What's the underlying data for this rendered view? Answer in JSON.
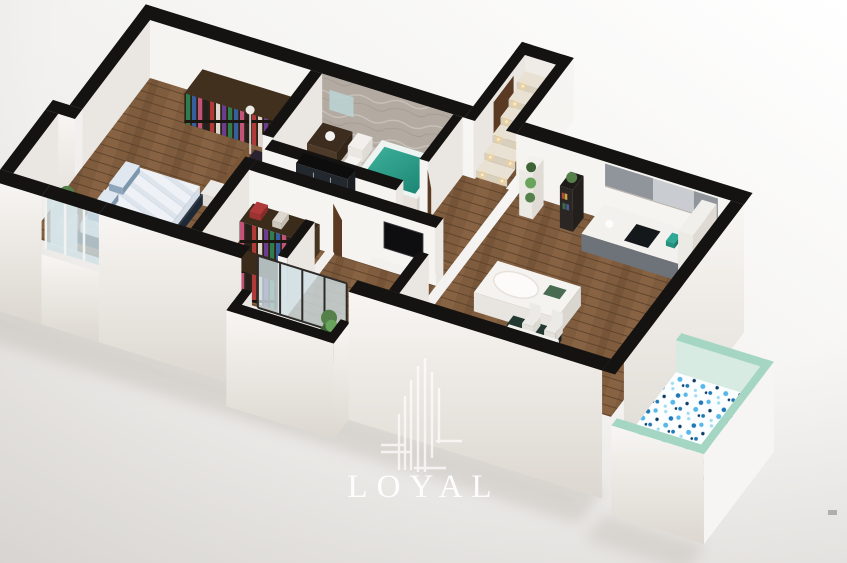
{
  "logo": {
    "brand": "LOYAL"
  },
  "palette": {
    "bg_top": "#ffffff",
    "bg_bottom": "#e7e5e2",
    "vignette": "#bbb7b2",
    "wall_top": "#151312",
    "wall_face": "#f6f4f1",
    "wall_face_shade": "#eae6e1",
    "wall_inner": "#efece7",
    "facade_hi": "#f8f6f3",
    "facade_lo": "#dcd7d0",
    "wood": "#7e5c3d",
    "wood_light": "#8d6a47",
    "wood_dark": "#6b4c33",
    "plank": "#5a3f29",
    "tile": "#cdc6be",
    "tile_line": "#bbb3aa",
    "marble": "#b3aba2",
    "marble_vein": "#d0c9c1",
    "marble_dark": "#978e84",
    "tub_teal": "#3fb39e",
    "tub_teal_deep": "#17806e",
    "tub_rim": "#eef4f1",
    "glass": "#cfe0e5",
    "frame_dark": "#2e2b28",
    "frame_white": "#f2f2f0",
    "bed_base": "#2e3b49",
    "bed_base_dark": "#232f3b",
    "duvet": "#eef1f5",
    "duvet_shade": "#dde4ec",
    "pillow": "#8ea6bc",
    "pillow_top": "#dfe7f0",
    "wardrobe": "#41301d",
    "wardrobe_side": "#4e3a24",
    "wardrobe_dark": "#2e2214",
    "desk": "#7a5536",
    "desk_face": "#6e4c30",
    "desk_side": "#5a3c25",
    "monitor": "#8046a8",
    "chair_white": "#eceae6",
    "chair_shade": "#dcd8d2",
    "tv": "#0e0e10",
    "console": "#f3f1ed",
    "console_face": "#e9e6e1",
    "console_side": "#ddd9d3",
    "cab_face": "#6e737a",
    "cab_side": "#585d63",
    "cab_upper": "#8f959b",
    "cab_upper_light": "#c9ccd0",
    "counter": "#f2f1ee",
    "cooktop": "#15181b",
    "kettle_teal": "#2fa896",
    "island_top": "#f5f3f0",
    "island_face": "#e8e5e0",
    "island_side": "#d9d5cf",
    "bench_dark": "#233831",
    "table_top": "#f4f2ee",
    "table_face": "#e3e0da",
    "shelf_dark": "#2b2623",
    "shelf_white": "#f3f1ed",
    "plant": "#55804a",
    "plant_dark": "#3e6336",
    "plant_light": "#6aa45c",
    "pot": "#a8a49c",
    "mint": "#a5d6c4",
    "mint_light": "#d7ebe2",
    "terrace_white": "#f6f5f3",
    "mosaic_bg": "#fbfdfe",
    "mosaic_blue": "#57b8e8",
    "mosaic_deep": "#1f77b5",
    "mosaic_navy": "#0b3a63",
    "mosaic_pale": "#9fdcf2",
    "step_light": "#ffd685",
    "step_top": "#e9e2d4",
    "step_riser": "#d8cfbd",
    "door_brown": "#5a3a22",
    "shadow": "#c4bfb9",
    "logo_white": "#ffffff",
    "clothes": [
      "#b03a3a",
      "#ddd7ce",
      "#6a3d8f",
      "#2e7d4f",
      "#375e9e",
      "#c2547a",
      "#23201d"
    ]
  },
  "floorplan": {
    "rooms": [
      {
        "id": "master-bedroom"
      },
      {
        "id": "bathroom"
      },
      {
        "id": "hallway"
      },
      {
        "id": "walk-in-closet"
      },
      {
        "id": "tv-room"
      },
      {
        "id": "entry-staircase"
      },
      {
        "id": "living-dining-kitchen"
      },
      {
        "id": "front-balcony"
      },
      {
        "id": "terrace"
      }
    ],
    "furniture": [
      "double-bed",
      "wardrobe",
      "desk-with-monitor",
      "bathtub",
      "vanity",
      "toilet",
      "clothes-racks",
      "wall-tv",
      "media-console",
      "kitchen-cabinets",
      "kitchen-island",
      "dining-table",
      "dining-chairs",
      "bookshelf",
      "plant-shelf",
      "staircase-lights",
      "potted-plants"
    ]
  }
}
